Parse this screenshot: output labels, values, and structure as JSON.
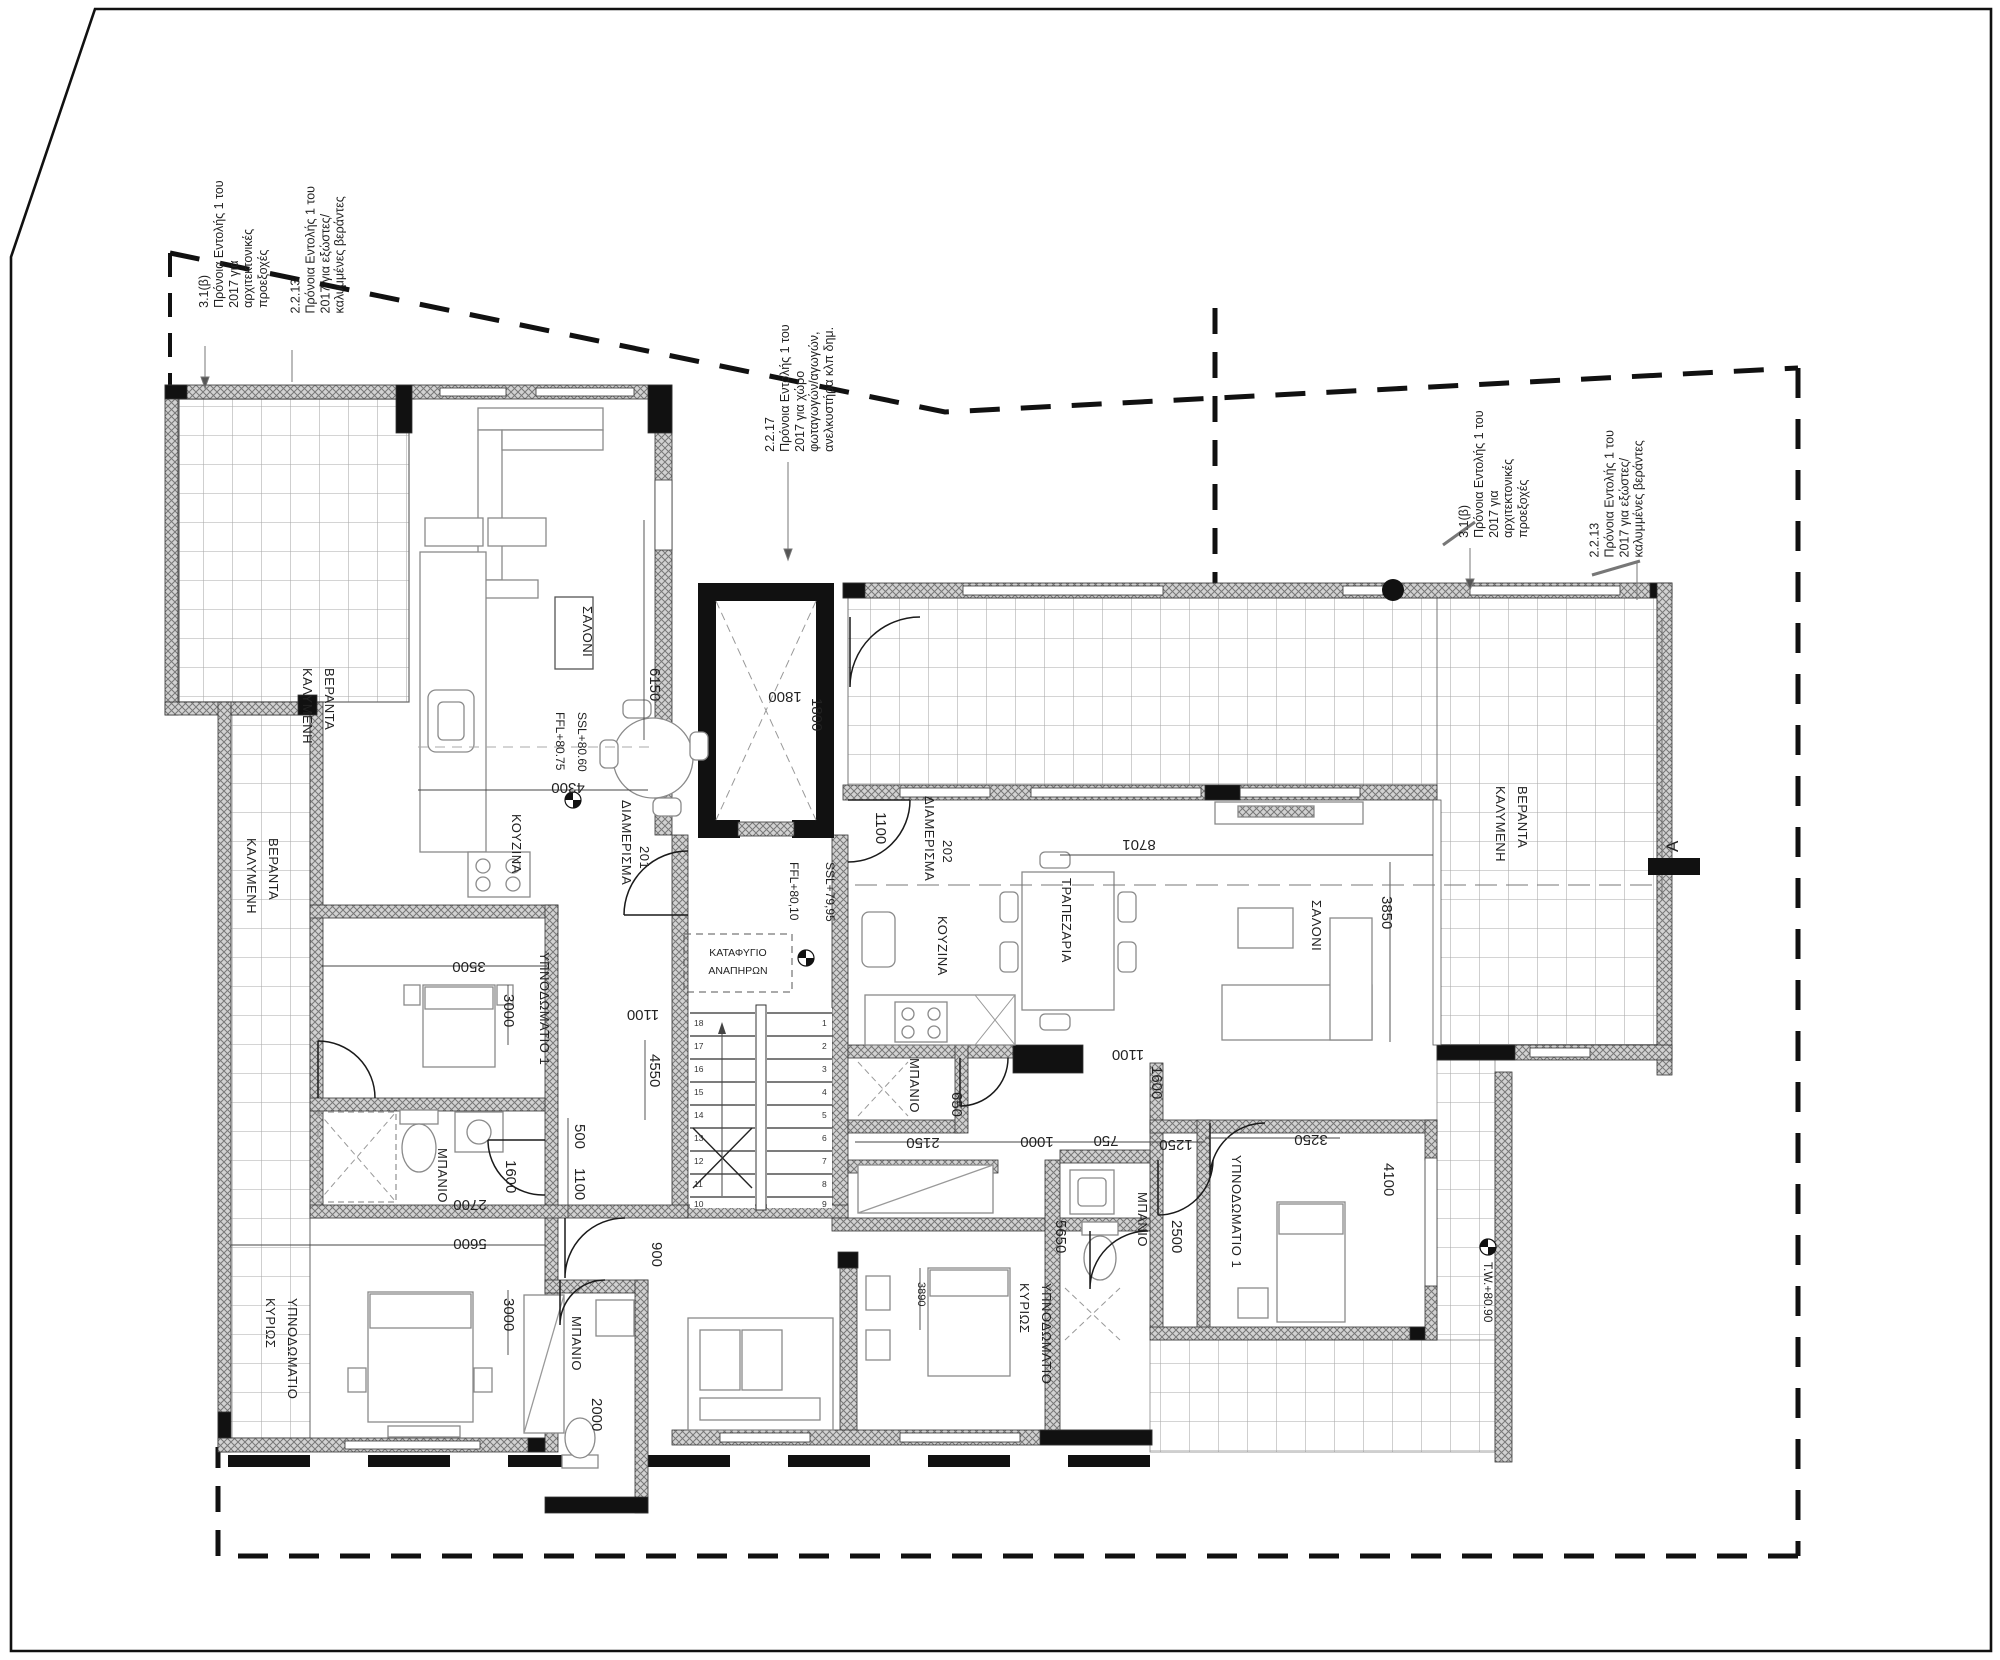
{
  "drawing_type": "floor plan",
  "annotations": {
    "left_a": "3.1(β)\nΠρόνοια Εντολής 1 του\n2017 για\nαρχιτεκτονικές\nπροεξοχές",
    "left_b": "2.2.13\nΠρόνοια Εντολής 1 του\n2017 για εξώστες/\nκαλυμμένες βεράντες",
    "middle": "2.2.17\nΠρόνοια Εντολής 1 του\n2017 για χώρο\nφωταγωγών/αγωγών,\nανελκυστήρα κλπ δημ.",
    "right_a": "3.1(β)\nΠρόνοια Εντολής 1 του\n2017 για\nαρχιτεκτονικές\nπροεξοχές",
    "right_b": "2.2.13\nΠρόνοια Εντολής 1 του\n2017 για εξώστες/\nκαλυμμένες βεράντες"
  },
  "apt201": {
    "name": "ΔΙΑΜΕΡΙΣΜΑ",
    "number": "201",
    "living": "ΣΑΛΟΝΙ",
    "kitchen": "ΚΟΥΖΙΝΑ",
    "bedroom1": "ΥΠΝΟΔΩΜΑΤΙΟ 1",
    "bath": "ΜΠΑΝΙΟ",
    "bath2": "ΜΠΑΝΙΟ",
    "master1": "ΚΥΡΙΩΣ",
    "master2": "ΥΠΝΟΔΩΜΑΤΙΟ",
    "veranda_top1": "ΚΑΛΥΜΕΝΗ",
    "veranda_top2": "ΒΕΡΑΝΤΑ",
    "veranda_side1": "ΚΑΛΥΜΕΝΗ",
    "veranda_side2": "ΒΕΡΑΝΤΑ",
    "ffl": "FFL+80.75",
    "ssl": "SSL+80.60",
    "dims": {
      "d6150": "6150",
      "d4300": "4300",
      "d3500": "3500",
      "d3000a": "3000",
      "d1600": "1600",
      "d2700": "2700",
      "d500": "500",
      "d1100a": "1100",
      "d1100b": "1100",
      "d900": "900",
      "d4550": "4550",
      "d5600": "5600",
      "d3000b": "3000",
      "d2000": "2000"
    }
  },
  "apt202": {
    "name": "ΔΙΑΜΕΡΙΣΜΑ",
    "number": "202",
    "living": "ΣΑΛΟΝΙ",
    "kitchen": "ΚΟΥΖΙΝΑ",
    "dining": "ΤΡΑΠΕΖΑΡΙΑ",
    "bedroom1": "ΥΠΝΟΔΩΜΑΤΙΟ 1",
    "bath_wc": "ΜΠΑΝΙΟ",
    "bath_main": "ΜΠΑΝΙΟ",
    "master1": "ΚΥΡΙΩΣ",
    "master2": "ΥΠΝΟΔΩΜΑΤΙΟ",
    "veranda1": "ΚΑΛΥΜΕΝΗ",
    "veranda2": "ΒΕΡΑΝΤΑ",
    "dims": {
      "d1100a": "1100",
      "d8701": "8701",
      "d3850": "3850",
      "d650": "650",
      "d2150": "2150",
      "d1000": "1000",
      "d750": "750",
      "d1250": "1250",
      "d1100b": "1100",
      "d1600": "1600",
      "d3250": "3250",
      "d4100": "4100",
      "d2500": "2500",
      "d5650": "5650",
      "d3890": "3890"
    }
  },
  "core": {
    "shelter1": "ΚΑΤΑΦΥΓΙΟ",
    "shelter2": "ΑΝΑΠΗΡΩΝ",
    "ffl": "FFL+80,10",
    "ssl": "SSL+79,95",
    "elev_w": "1800",
    "elev_h": "1800",
    "stairs_left": [
      "18",
      "17",
      "16",
      "15",
      "14",
      "13",
      "12",
      "11",
      "10"
    ],
    "stairs_right": [
      "1",
      "2",
      "3",
      "4",
      "5",
      "6",
      "7",
      "8",
      "9"
    ]
  },
  "site": {
    "tw": "T.W.+80.90",
    "section": "A"
  },
  "colors": {
    "ink": "#1a1a1a",
    "wall_hatch": "#8f8f8f",
    "tile": "#a8a8a8",
    "furniture": "#8a8a8a"
  }
}
